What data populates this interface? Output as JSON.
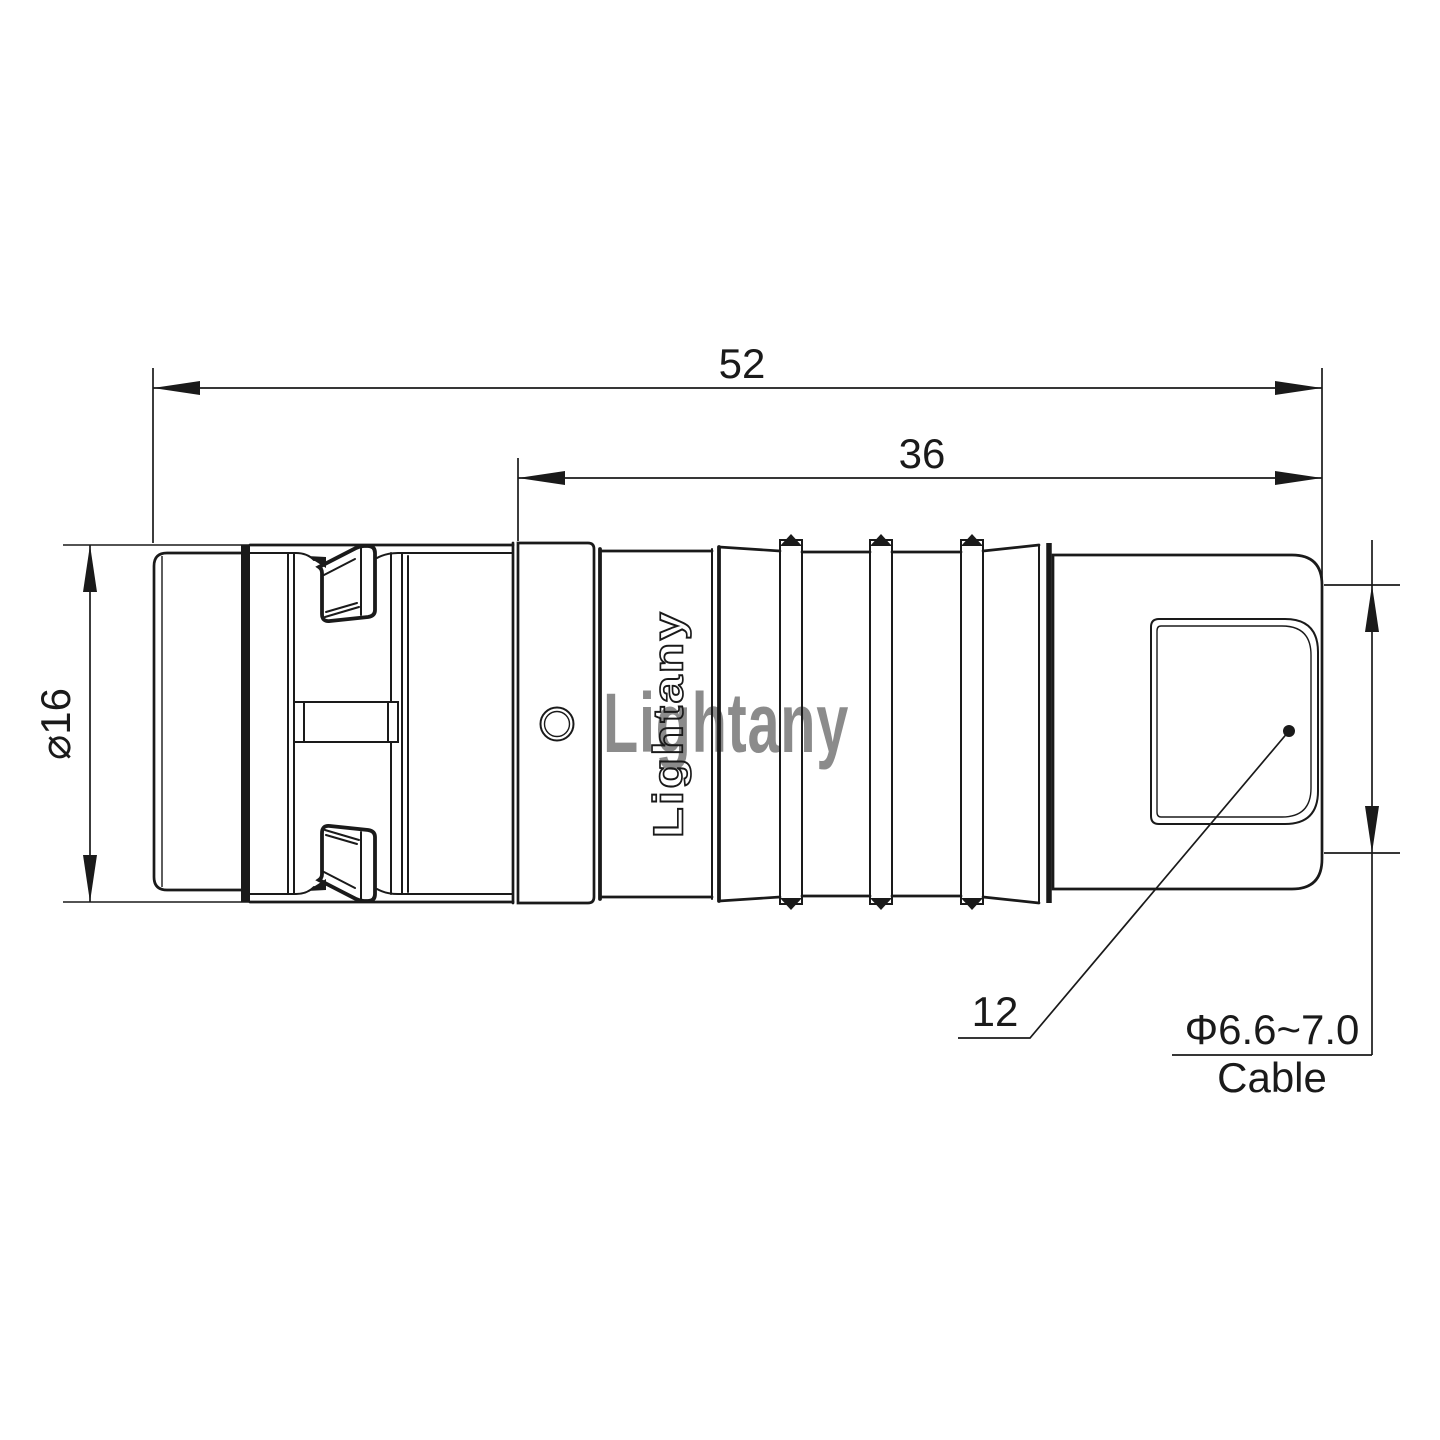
{
  "drawing": {
    "engraving": "Lightany",
    "watermark": "Lightany",
    "dimensions": {
      "overall_length": "52",
      "grip_length": "36",
      "shell_diameter": "⌀16",
      "rear_width": "12",
      "cable_diameter": "Φ6.6~7.0",
      "cable_label": "Cable"
    },
    "colors": {
      "line": "#1a1a1a",
      "background": "#ffffff",
      "watermark": "#e08f8f"
    }
  }
}
